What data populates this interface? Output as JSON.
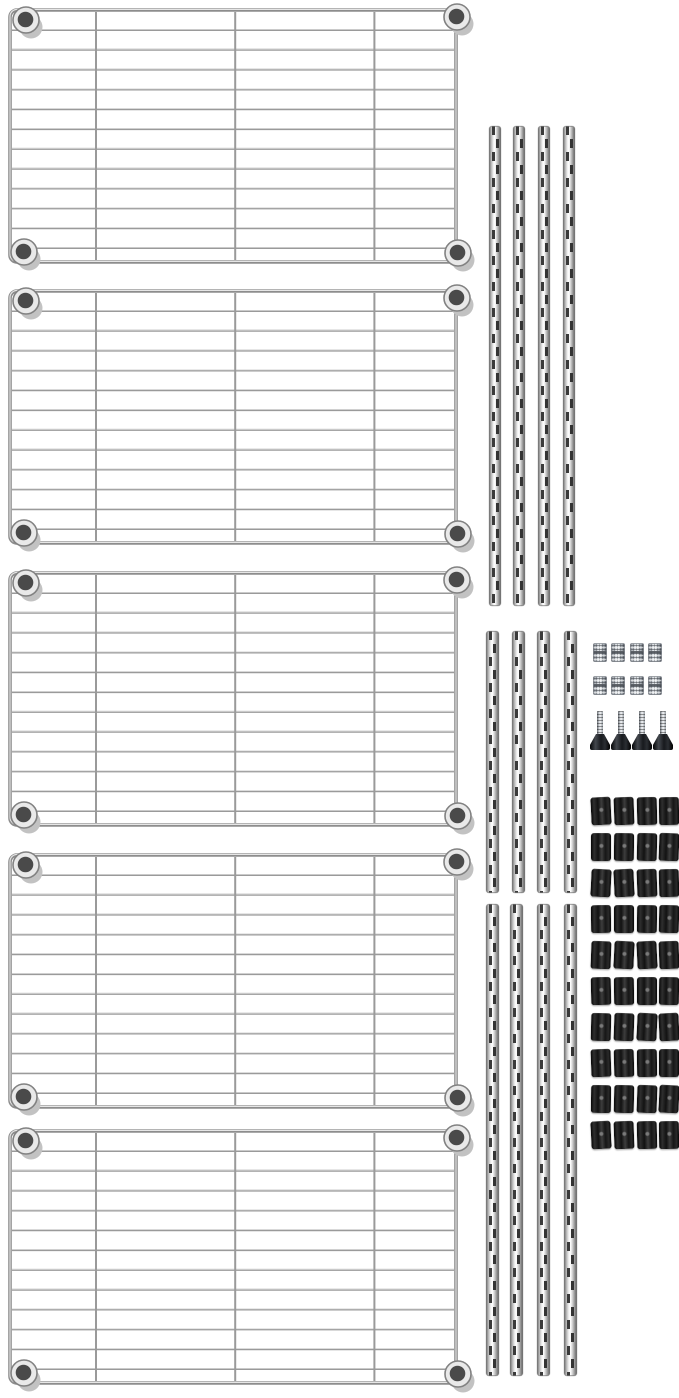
{
  "page": {
    "background": "#ffffff",
    "description": "Chrome wire shelving unit parts kit laid out on a white background"
  },
  "colors": {
    "chrome_wire": "#9a9a9a",
    "chrome_highlight": "#e6e6e6",
    "pole_groove_slot": "#3b3b3b",
    "knurled_steel": "#aab0b6",
    "black_plastic": "#1c1c1c"
  },
  "parts": {
    "wire_shelves": {
      "label": "chrome wire shelf",
      "count": 5,
      "grid_columns": 4,
      "grid_rows": 13,
      "corner_collars_per_shelf": 4
    },
    "pole_groups": [
      {
        "id": "top",
        "label": "long grooved pole section",
        "count": 4
      },
      {
        "id": "middle",
        "label": "short grooved pole section",
        "count": 4
      },
      {
        "id": "bottom",
        "label": "long grooved pole section",
        "count": 4
      }
    ],
    "pole_connectors": {
      "label": "knurled pole connector",
      "count": 8,
      "rows": 2,
      "cols": 4
    },
    "leveling_feet": {
      "label": "leveling foot with threaded stem",
      "count": 4
    },
    "sleeve_clips": {
      "label": "black split sleeve clip",
      "count": 40,
      "rows": 10,
      "cols": 4
    }
  }
}
